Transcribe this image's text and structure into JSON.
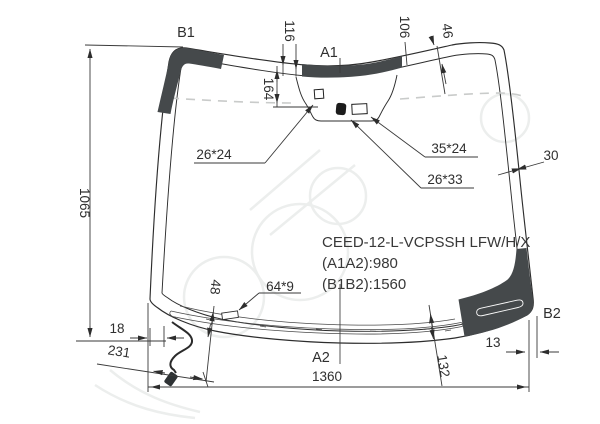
{
  "diagram": {
    "part_labels": {
      "b1": "B1",
      "a1": "A1",
      "a2": "A2",
      "b2": "B2"
    },
    "dimensions": {
      "top_band_left": "116",
      "mirror_height": "164",
      "top_band_right": "106",
      "band_width_top_right": "46",
      "side_band_right": "30",
      "glass_height": "1065",
      "mirror_button": "26*24",
      "sensor_right": "35*24",
      "sensor_center": "26*33",
      "connector_offset": "48",
      "connector_size": "64*9",
      "wire_edge_offset": "18",
      "wire_length": "231",
      "bottom_corner_right": "13",
      "bottom_band": "132",
      "glass_width": "1360"
    },
    "title": {
      "model_code": "CEED-12-L-VCPSSH LFW/H/X",
      "a_span": "(A1A2):980",
      "b_span": "(B1B2):1560"
    }
  }
}
